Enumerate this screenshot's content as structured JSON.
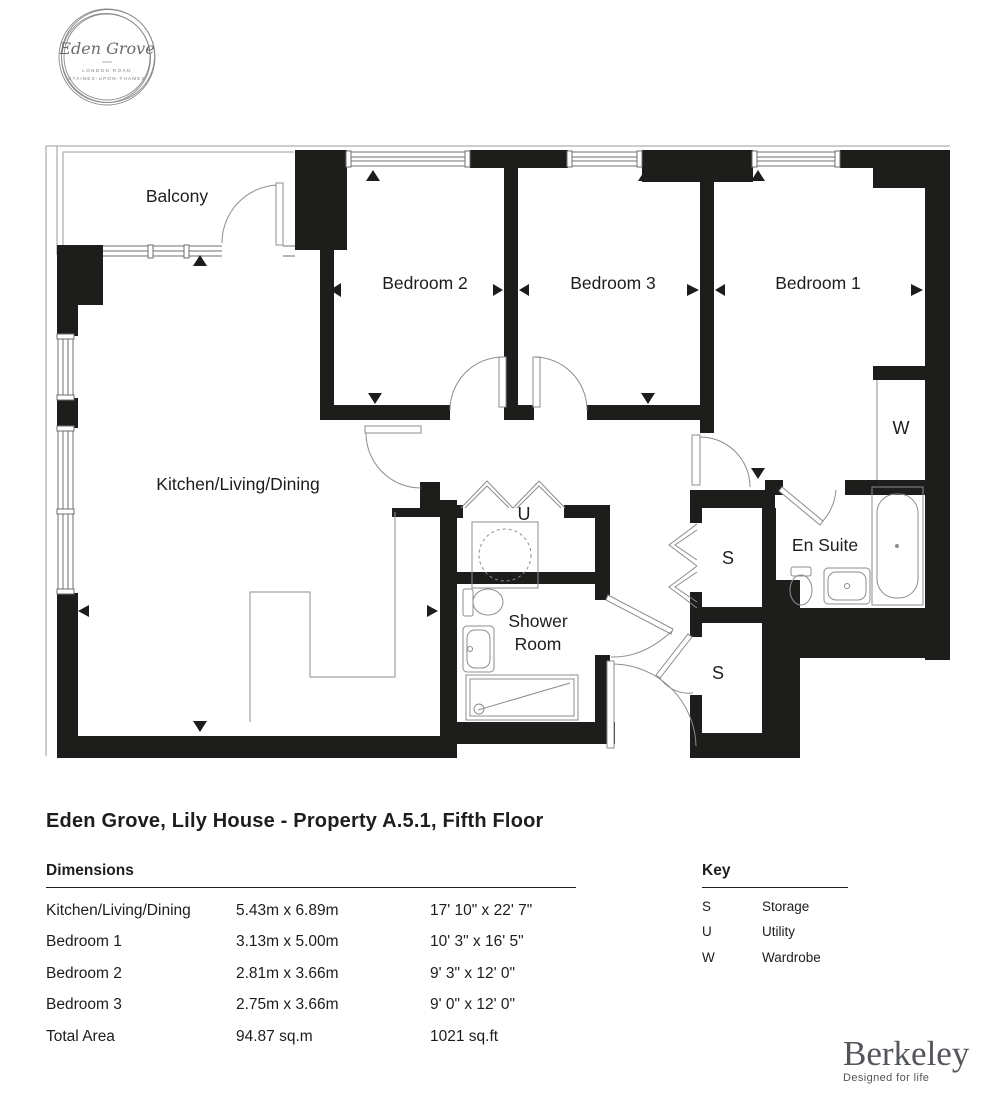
{
  "logo": {
    "name": "Eden Grove",
    "address_line1": "LONDON ROAD",
    "address_line2": "STAINES-UPON-THAMES"
  },
  "plan": {
    "rooms": {
      "balcony": "Balcony",
      "bedroom2": "Bedroom 2",
      "bedroom3": "Bedroom 3",
      "bedroom1": "Bedroom 1",
      "kitchen": "Kitchen/Living/Dining",
      "utility_symbol": "U",
      "shower_line1": "Shower",
      "shower_line2": "Room",
      "storage_upper_symbol": "S",
      "storage_lower_symbol": "S",
      "ensuite": "En Suite",
      "wardrobe_symbol": "W"
    }
  },
  "title": "Eden Grove, Lily House - Property A.5.1, Fifth Floor",
  "dimensions": {
    "heading": "Dimensions",
    "rows": [
      {
        "room": "Kitchen/Living/Dining",
        "metric": "5.43m x 6.89m",
        "imperial": "17' 10\" x 22' 7\""
      },
      {
        "room": "Bedroom 1",
        "metric": "3.13m x 5.00m",
        "imperial": "10' 3\" x 16' 5\""
      },
      {
        "room": "Bedroom 2",
        "metric": "2.81m x 3.66m",
        "imperial": "9' 3\" x 12' 0\""
      },
      {
        "room": "Bedroom 3",
        "metric": "2.75m x 3.66m",
        "imperial": "9' 0\" x 12' 0\""
      },
      {
        "room": "Total Area",
        "metric": "94.87 sq.m",
        "imperial": "1021 sq.ft"
      }
    ]
  },
  "key": {
    "heading": "Key",
    "items": [
      {
        "symbol": "S",
        "label": "Storage"
      },
      {
        "symbol": "U",
        "label": "Utility"
      },
      {
        "symbol": "W",
        "label": "Wardrobe"
      }
    ]
  },
  "brand": {
    "name": "Berkeley",
    "tagline": "Designed for life"
  },
  "colors": {
    "wall": "#1d1d1b",
    "line": "#8c8c8c",
    "brand_gray": "#53565a"
  }
}
